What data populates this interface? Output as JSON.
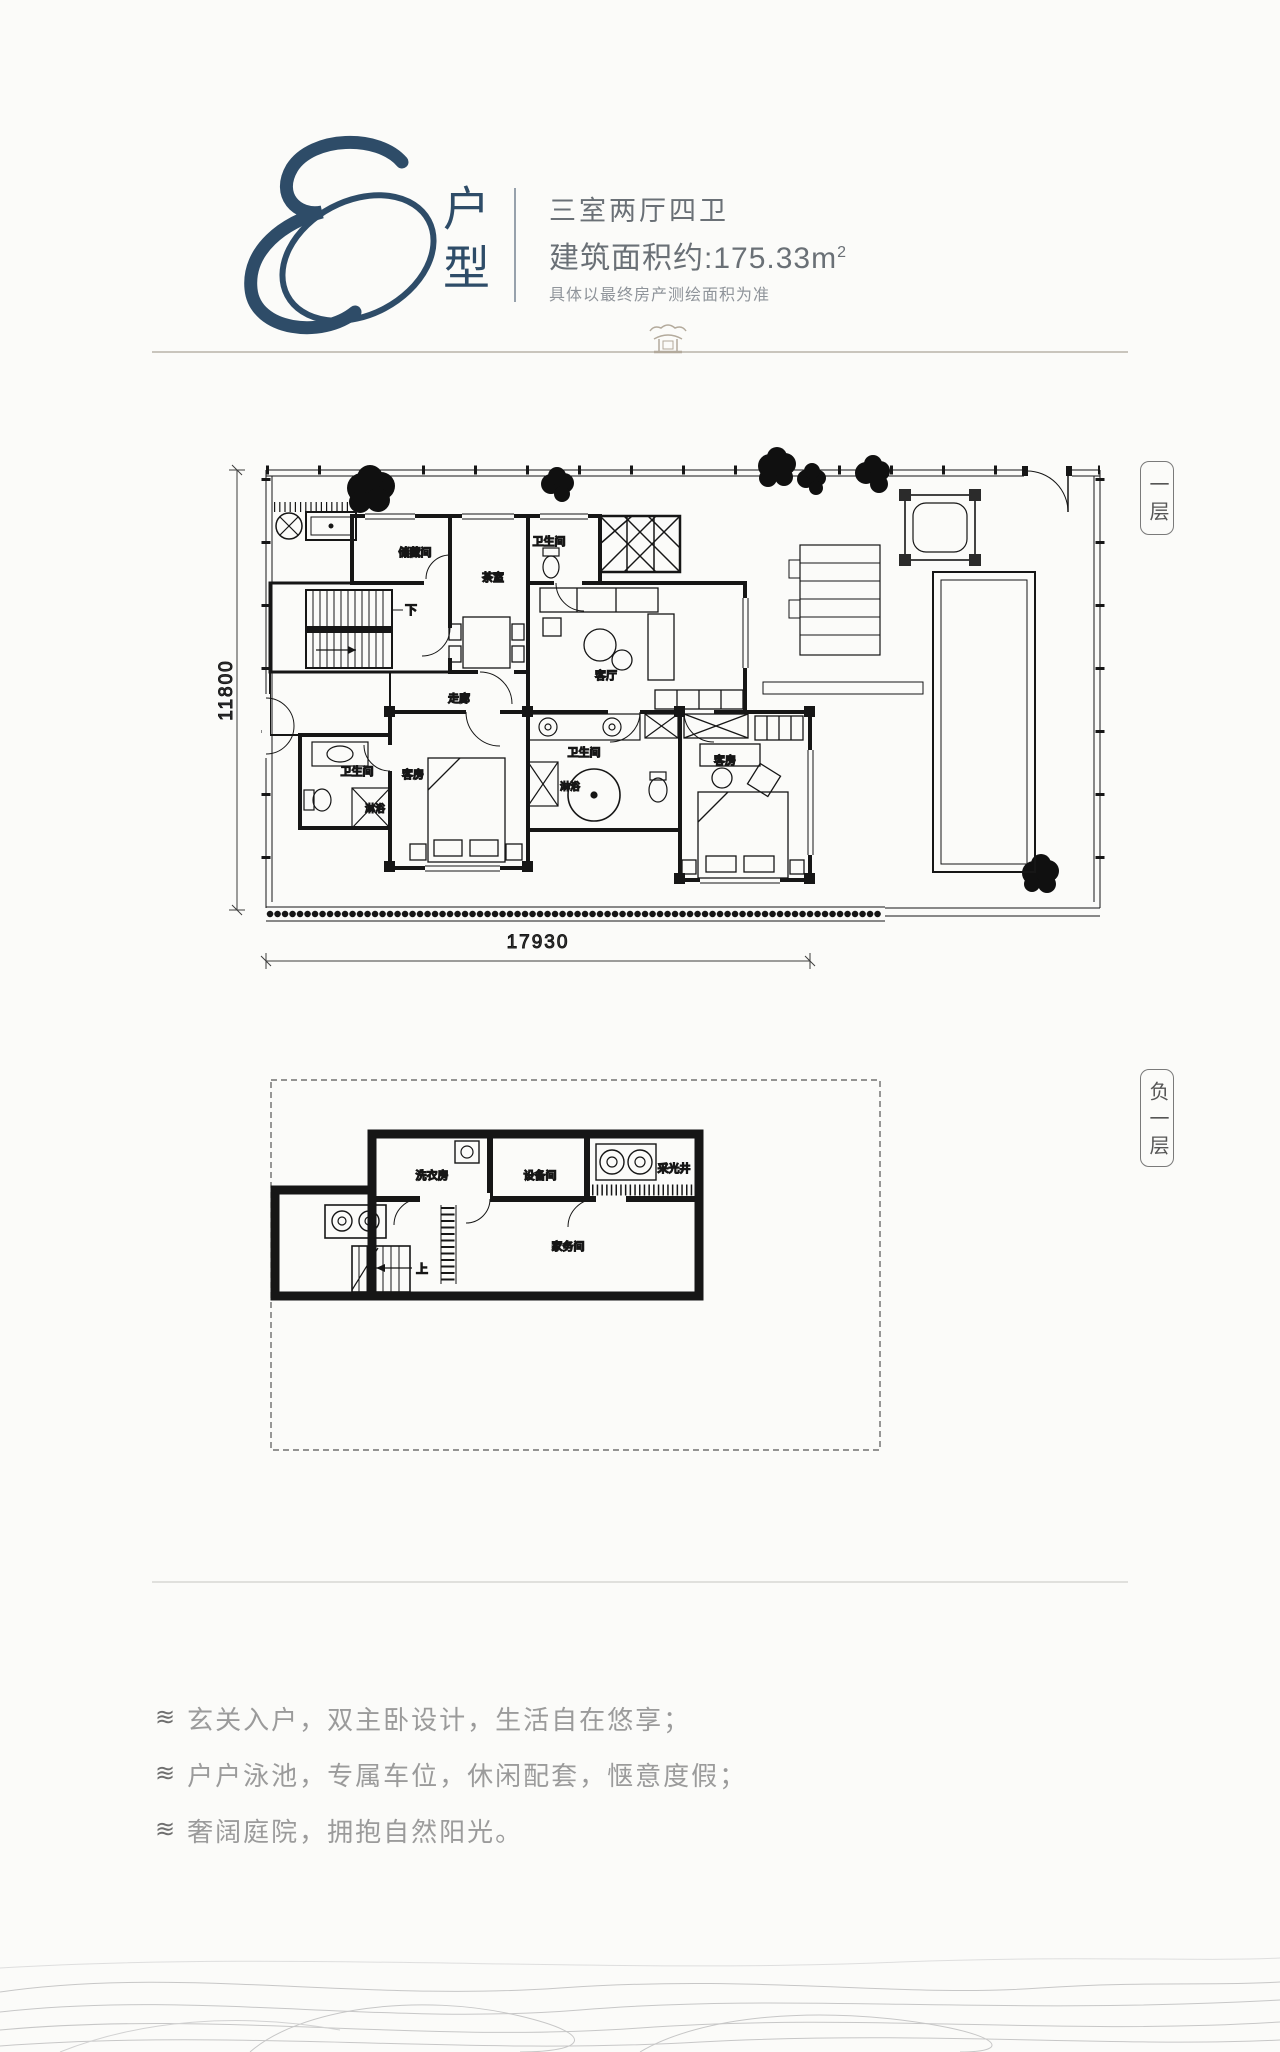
{
  "page": {
    "background": "#fbfbf9"
  },
  "header": {
    "logo_letter": "E",
    "logo_color": "#2e4c68",
    "type_label": "户型",
    "unit_layout": "三室两厅四卫",
    "area_text": "建筑面积约:175.33m",
    "area_superscript": "2",
    "disclaimer": "具体以最终房产测绘面积为准"
  },
  "floor1": {
    "tag": "一层",
    "dim_width": "17930",
    "dim_height": "11800",
    "rooms": {
      "storage": "储藏间",
      "tea_room": "茶室",
      "bath_top": "卫生间",
      "living": "客厅",
      "corridor": "走廊",
      "stairs_down": "下",
      "bath_left": "卫生间",
      "shower_left": "淋浴",
      "guest_left": "客房",
      "bath_master": "卫生间",
      "shower_master": "淋浴",
      "guest_right": "客房"
    }
  },
  "basement": {
    "tag": "负一层",
    "rooms": {
      "laundry": "洗衣房",
      "equipment": "设备间",
      "light_well": "采光井",
      "utility": "家务间",
      "stairs_up": "上"
    }
  },
  "features": {
    "bullet_icon": "≋",
    "items": [
      "玄关入户，双主卧设计，生活自在悠享；",
      "户户泳池，专属车位，休闲配套，惬意度假；",
      "奢阔庭院，拥抱自然阳光。"
    ]
  }
}
